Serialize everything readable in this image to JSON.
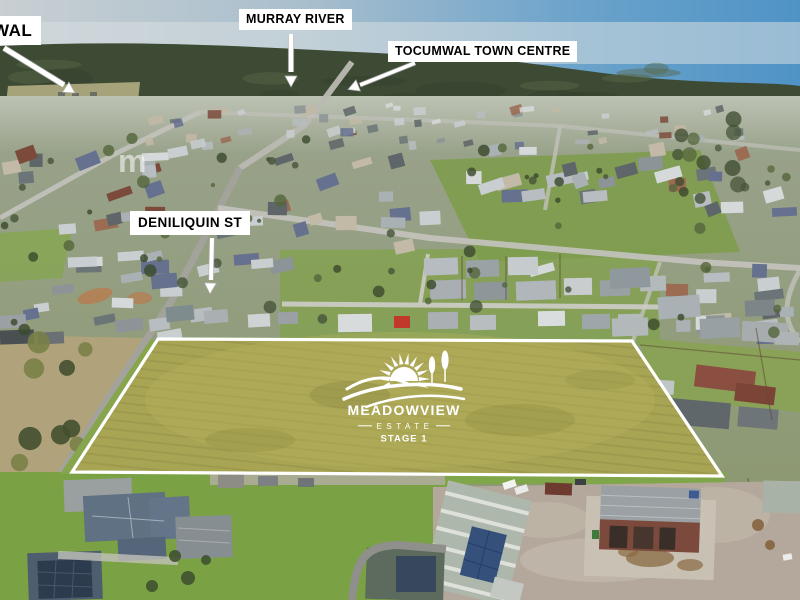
{
  "labels": {
    "partial_top_left": "WAL",
    "murray_river": "MURRAY RIVER",
    "town_centre": "TOCUMWAL TOWN CENTRE",
    "deniliquin_st": "DENILIQUIN ST"
  },
  "estate_logo": {
    "name": "MEADOWVIEW",
    "type_line": "ESTATE",
    "stage_line": "STAGE 1"
  },
  "watermark": "m",
  "colors": {
    "label_background": "#ffffff",
    "label_text": "#000000",
    "boundary_line": "#ffffff",
    "parcel_field": "#a7a454",
    "logo_white": "#ffffff",
    "sky_left": "#c9cfd3",
    "sky_right": "#4f93c6",
    "forest_green": "#3e4b34"
  }
}
